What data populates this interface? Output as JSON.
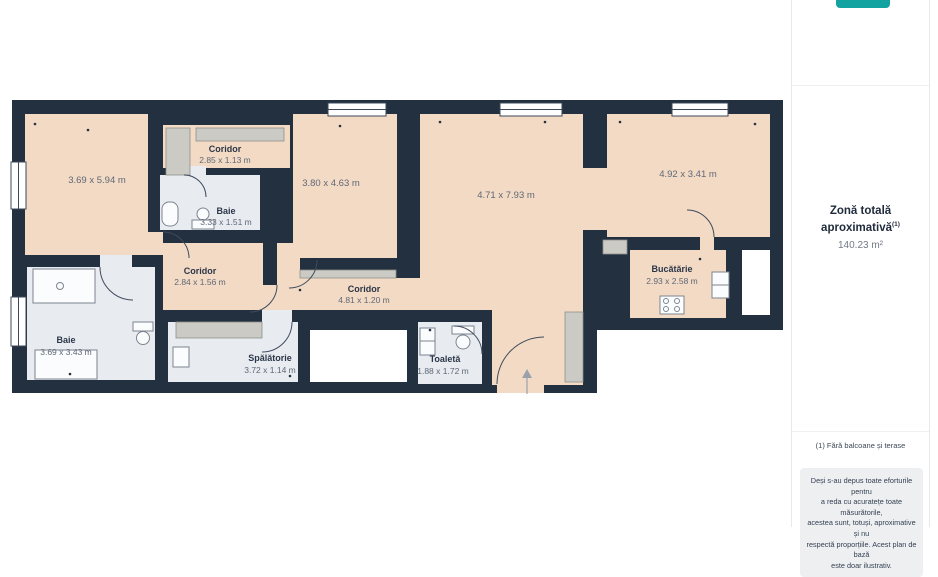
{
  "plan": {
    "rooms": [
      {
        "id": "living-left",
        "name": "",
        "dims": "3.69 x 5.94 m"
      },
      {
        "id": "coridor-top",
        "name": "Coridor",
        "dims": "2.85 x 1.13 m"
      },
      {
        "id": "baie-top",
        "name": "Baie",
        "dims": "3.33 x 1.51 m"
      },
      {
        "id": "room-middle",
        "name": "",
        "dims": "3.80 x 4.63 m"
      },
      {
        "id": "living-center",
        "name": "",
        "dims": "4.71 x 7.93 m"
      },
      {
        "id": "room-right",
        "name": "",
        "dims": "4.92 x 3.41 m"
      },
      {
        "id": "coridor-left",
        "name": "Coridor",
        "dims": "2.84 x 1.56 m"
      },
      {
        "id": "coridor-main",
        "name": "Coridor",
        "dims": "4.81 x 1.20 m"
      },
      {
        "id": "bucatarie",
        "name": "Bucătărie",
        "dims": "2.93 x 2.58 m"
      },
      {
        "id": "baie-bottom",
        "name": "Baie",
        "dims": "3.69 x 3.43 m"
      },
      {
        "id": "spalatorie",
        "name": "Spălătorie",
        "dims": "3.72 x 1.14 m"
      },
      {
        "id": "toaleta",
        "name": "Toaletă",
        "dims": "1.88 x 1.72 m"
      }
    ],
    "colors": {
      "wall": "#22303f",
      "floor": "#f3dac5",
      "wet_floor": "#e8ecf1",
      "closet": "#cbcac5",
      "accent": "#12a3a0"
    }
  },
  "sidebar": {
    "total_area_label": "Zonă totală aproximativă",
    "total_area_superscript": "(1)",
    "total_area_value": "140.23 m²",
    "footnote": "(1) Fără balcoane și terase",
    "disclaimer_lines": [
      "Deși s-au depus toate eforturile pentru",
      "a reda cu acuratețe toate măsurătorile,",
      "acestea sunt, totuși, aproximative și nu",
      "respectă proporțiile. Acest plan de bază",
      "este doar ilustrativ."
    ]
  }
}
